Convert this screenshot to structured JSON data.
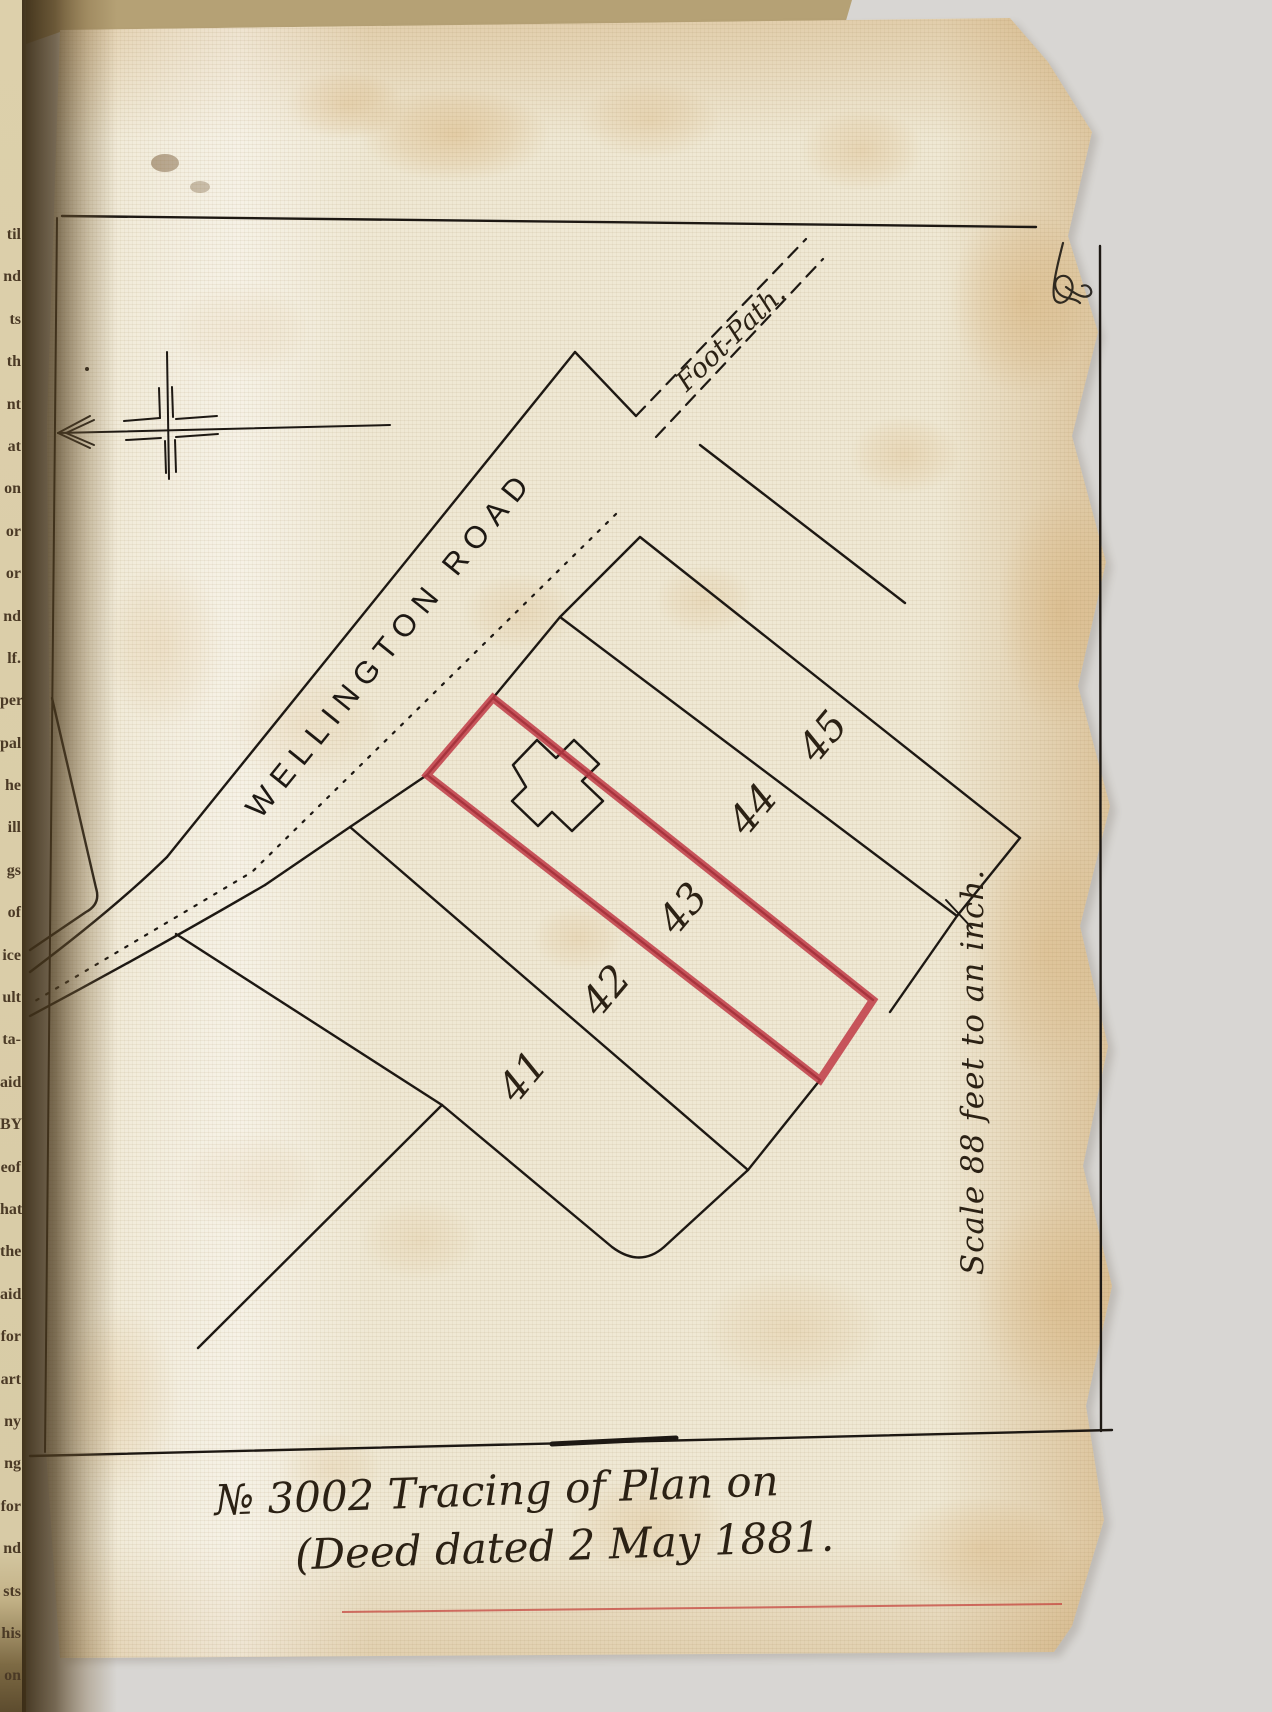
{
  "page": {
    "plan": {
      "road_label": "WELLINGTON ROAD",
      "footpath_label": "Foot-Path.",
      "plots": [
        "41",
        "42",
        "43",
        "44",
        "45"
      ],
      "highlighted_plot": "43",
      "highlight_color": "#c03a45"
    },
    "scale_note": "Scale 88 feet to an inch.",
    "caption": {
      "line1": "№ 3002 Tracing of Plan on",
      "line2": "(Deed dated 2 May 1881."
    },
    "margin_fragments": [
      "til",
      "nd",
      "ts",
      "th",
      "nt",
      "at",
      "on",
      "or",
      "or",
      "nd",
      "lf.",
      "per",
      "pal",
      "he",
      "ill",
      "gs",
      "of",
      "ice",
      "ult",
      "ta-",
      "aid",
      "BY",
      "eof",
      "hat",
      "the",
      "aid",
      "for",
      "art",
      "ny",
      "ng",
      "for",
      "nd",
      "sts",
      "his",
      "on"
    ],
    "colors": {
      "ink": "#1d1813",
      "plot_outline_red": "#c03a45",
      "page": "#efe8d4",
      "background": "#d8d6d3"
    }
  }
}
